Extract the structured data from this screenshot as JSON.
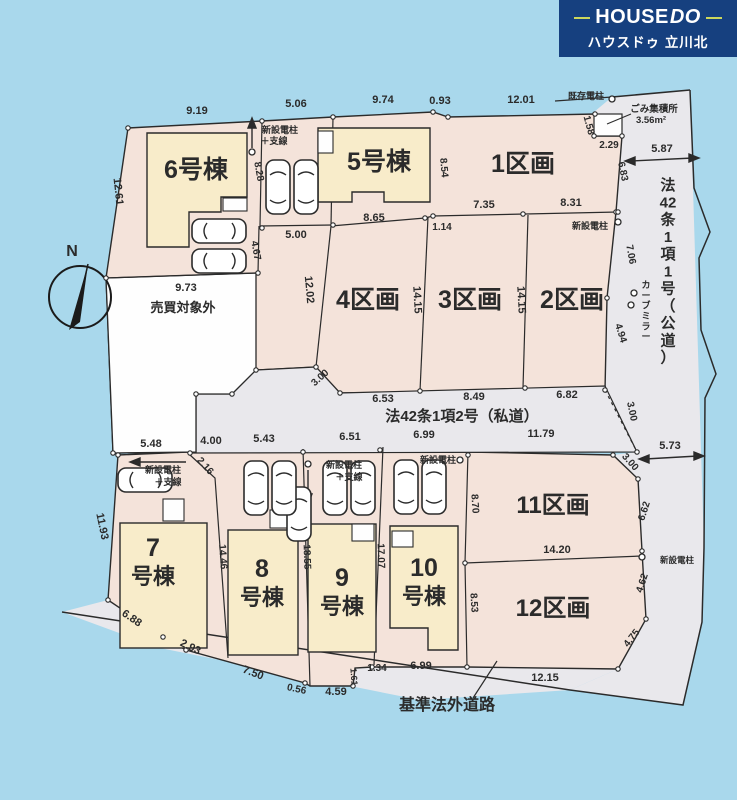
{
  "header": {
    "brand": "HOUSE",
    "brand2": "DO",
    "subtitle": "ハウスドゥ 立川北",
    "colors": {
      "navy": "#16407f",
      "accent_rule": "#ccd75c",
      "text": "#ffffff"
    }
  },
  "plan": {
    "colors": {
      "background": "#a9d8ec",
      "lot_pink": "#f4e3da",
      "road_gray": "#e9e8ec",
      "building_cream": "#f8ecca",
      "white_area": "#fefefe",
      "line_ink": "#2b2b2b"
    },
    "labels": [
      {
        "t": "9.19",
        "x": 197,
        "y": 114,
        "s": 11,
        "n": "dim-label"
      },
      {
        "t": "5.06",
        "x": 296,
        "y": 107,
        "s": 11,
        "n": "dim-label"
      },
      {
        "t": "9.74",
        "x": 383,
        "y": 103,
        "s": 11,
        "n": "dim-label"
      },
      {
        "t": "0.93",
        "x": 440,
        "y": 104,
        "s": 11,
        "n": "dim-label"
      },
      {
        "t": "12.01",
        "x": 521,
        "y": 103,
        "s": 11,
        "n": "dim-label"
      },
      {
        "t": "1.58",
        "x": 586,
        "y": 126,
        "s": 10,
        "r": 75,
        "n": "dim-label"
      },
      {
        "t": "2.29",
        "x": 609,
        "y": 148,
        "s": 10,
        "n": "dim-label"
      },
      {
        "t": "5.87",
        "x": 662,
        "y": 152,
        "s": 11,
        "n": "dim-label"
      },
      {
        "t": "6.83",
        "x": 620,
        "y": 172,
        "s": 10,
        "r": 78,
        "n": "dim-label"
      },
      {
        "t": "12.61",
        "x": 115,
        "y": 192,
        "s": 11,
        "r": 84,
        "n": "dim-label"
      },
      {
        "t": "8.28",
        "x": 256,
        "y": 172,
        "s": 10,
        "r": 80,
        "n": "dim-label"
      },
      {
        "t": "8.54",
        "x": 441,
        "y": 168,
        "s": 10,
        "r": 85,
        "n": "dim-label"
      },
      {
        "t": "5.00",
        "x": 296,
        "y": 238,
        "s": 11,
        "n": "dim-label"
      },
      {
        "t": "8.65",
        "x": 374,
        "y": 221,
        "s": 11,
        "n": "dim-label"
      },
      {
        "t": "1.14",
        "x": 442,
        "y": 230,
        "s": 10,
        "n": "dim-label"
      },
      {
        "t": "7.35",
        "x": 484,
        "y": 208,
        "s": 11,
        "n": "dim-label"
      },
      {
        "t": "8.31",
        "x": 571,
        "y": 206,
        "s": 11,
        "n": "dim-label"
      },
      {
        "t": "4.67",
        "x": 253,
        "y": 251,
        "s": 10,
        "r": 80,
        "n": "dim-label"
      },
      {
        "t": "9.73",
        "x": 186,
        "y": 291,
        "s": 11,
        "n": "dim-label"
      },
      {
        "t": "12.02",
        "x": 306,
        "y": 290,
        "s": 11,
        "r": 85,
        "n": "dim-label"
      },
      {
        "t": "14.15",
        "x": 414,
        "y": 300,
        "s": 11,
        "r": 87,
        "n": "dim-label"
      },
      {
        "t": "14.15",
        "x": 518,
        "y": 300,
        "s": 11,
        "r": 87,
        "n": "dim-label"
      },
      {
        "t": "7.06",
        "x": 628,
        "y": 255,
        "s": 10,
        "r": 80,
        "n": "dim-label"
      },
      {
        "t": "4.94",
        "x": 618,
        "y": 334,
        "s": 10,
        "r": 72,
        "n": "dim-label"
      },
      {
        "t": "3.00",
        "x": 629,
        "y": 412,
        "s": 10,
        "r": 78,
        "n": "dim-label"
      },
      {
        "t": "3.00",
        "x": 322,
        "y": 380,
        "s": 10,
        "r": -42,
        "n": "dim-label"
      },
      {
        "t": "6.53",
        "x": 383,
        "y": 402,
        "s": 11,
        "n": "dim-label"
      },
      {
        "t": "8.49",
        "x": 474,
        "y": 400,
        "s": 11,
        "n": "dim-label"
      },
      {
        "t": "6.82",
        "x": 567,
        "y": 398,
        "s": 11,
        "n": "dim-label"
      },
      {
        "t": "5.73",
        "x": 670,
        "y": 449,
        "s": 11,
        "n": "dim-label"
      },
      {
        "t": "5.48",
        "x": 151,
        "y": 447,
        "s": 11,
        "n": "dim-label"
      },
      {
        "t": "4.00",
        "x": 211,
        "y": 444,
        "s": 11,
        "n": "dim-label"
      },
      {
        "t": "5.43",
        "x": 264,
        "y": 442,
        "s": 11,
        "n": "dim-label"
      },
      {
        "t": "6.51",
        "x": 350,
        "y": 440,
        "s": 11,
        "n": "dim-label"
      },
      {
        "t": "6.99",
        "x": 424,
        "y": 438,
        "s": 11,
        "n": "dim-label"
      },
      {
        "t": "11.79",
        "x": 541,
        "y": 437,
        "s": 11,
        "n": "dim-label"
      },
      {
        "t": "2.16",
        "x": 203,
        "y": 468,
        "s": 10,
        "r": 48,
        "n": "dim-label"
      },
      {
        "t": "3.00",
        "x": 628,
        "y": 464,
        "s": 10,
        "r": 48,
        "n": "dim-label"
      },
      {
        "t": "11.93",
        "x": 99,
        "y": 527,
        "s": 11,
        "r": 78,
        "n": "dim-label"
      },
      {
        "t": "14.46",
        "x": 220,
        "y": 557,
        "s": 10,
        "r": 86,
        "n": "dim-label"
      },
      {
        "t": "18.55",
        "x": 304,
        "y": 557,
        "s": 10,
        "r": 88,
        "n": "dim-label"
      },
      {
        "t": "17.07",
        "x": 378,
        "y": 556,
        "s": 10,
        "r": 88,
        "n": "dim-label"
      },
      {
        "t": "8.70",
        "x": 472,
        "y": 504,
        "s": 10,
        "r": 86,
        "n": "dim-label"
      },
      {
        "t": "8.53",
        "x": 471,
        "y": 603,
        "s": 10,
        "r": 86,
        "n": "dim-label"
      },
      {
        "t": "6.62",
        "x": 647,
        "y": 512,
        "s": 10,
        "r": -72,
        "n": "dim-label"
      },
      {
        "t": "14.20",
        "x": 557,
        "y": 553,
        "s": 11,
        "n": "dim-label"
      },
      {
        "t": "4.62",
        "x": 645,
        "y": 584,
        "s": 10,
        "r": -72,
        "n": "dim-label"
      },
      {
        "t": "4.75",
        "x": 634,
        "y": 640,
        "s": 10,
        "r": -52,
        "n": "dim-label"
      },
      {
        "t": "12.15",
        "x": 545,
        "y": 681,
        "s": 11,
        "n": "dim-label"
      },
      {
        "t": "6.88",
        "x": 130,
        "y": 621,
        "s": 11,
        "r": 34,
        "n": "dim-label"
      },
      {
        "t": "2.93",
        "x": 189,
        "y": 650,
        "s": 11,
        "r": 26,
        "n": "dim-label"
      },
      {
        "t": "7.50",
        "x": 252,
        "y": 676,
        "s": 11,
        "r": 21,
        "n": "dim-label"
      },
      {
        "t": "0.56",
        "x": 296,
        "y": 692,
        "s": 10,
        "r": 12,
        "n": "dim-label"
      },
      {
        "t": "4.59",
        "x": 336,
        "y": 695,
        "s": 11,
        "n": "dim-label"
      },
      {
        "t": "1.61",
        "x": 351,
        "y": 677,
        "s": 9,
        "r": 86,
        "n": "dim-label"
      },
      {
        "t": "1.34",
        "x": 377,
        "y": 671,
        "s": 10,
        "n": "dim-label"
      },
      {
        "t": "6.99",
        "x": 421,
        "y": 669,
        "s": 11,
        "n": "dim-label"
      },
      {
        "t": "1区画",
        "x": 523,
        "y": 172,
        "s": 25,
        "n": "lot-label-1"
      },
      {
        "t": "2区画",
        "x": 572,
        "y": 308,
        "s": 25,
        "n": "lot-label-2"
      },
      {
        "t": "3区画",
        "x": 470,
        "y": 308,
        "s": 25,
        "n": "lot-label-3"
      },
      {
        "t": "4区画",
        "x": 368,
        "y": 308,
        "s": 25,
        "n": "lot-label-4"
      },
      {
        "t": "11区画",
        "x": 553,
        "y": 513,
        "s": 24,
        "n": "lot-label-11"
      },
      {
        "t": "12区画",
        "x": 553,
        "y": 616,
        "s": 24,
        "n": "lot-label-12"
      },
      {
        "t": "6号棟",
        "x": 196,
        "y": 178,
        "s": 25,
        "n": "building-label-6"
      },
      {
        "t": "5号棟",
        "x": 379,
        "y": 170,
        "s": 25,
        "n": "building-label-5"
      },
      {
        "t": "7",
        "x": 153,
        "y": 556,
        "s": 25,
        "n": "building-label-7"
      },
      {
        "t": "号棟",
        "x": 153,
        "y": 584,
        "s": 22,
        "n": "building-label-7b"
      },
      {
        "t": "8",
        "x": 262,
        "y": 577,
        "s": 25,
        "n": "building-label-8"
      },
      {
        "t": "号棟",
        "x": 262,
        "y": 605,
        "s": 22,
        "n": "building-label-8b"
      },
      {
        "t": "9",
        "x": 342,
        "y": 586,
        "s": 25,
        "n": "building-label-9"
      },
      {
        "t": "号棟",
        "x": 342,
        "y": 614,
        "s": 22,
        "n": "building-label-9b"
      },
      {
        "t": "10",
        "x": 424,
        "y": 576,
        "s": 25,
        "n": "building-label-10"
      },
      {
        "t": "号棟",
        "x": 424,
        "y": 604,
        "s": 22,
        "n": "building-label-10b"
      },
      {
        "t": "売買対象外",
        "x": 183,
        "y": 312,
        "s": 13,
        "n": "excluded-area-label"
      },
      {
        "t": "法42条1項2号（私道）",
        "x": 462,
        "y": 421,
        "s": 15,
        "n": "road-label-private"
      },
      {
        "t": "基準法外道路",
        "x": 447,
        "y": 710,
        "s": 16,
        "n": "road-label-nonstandard"
      },
      {
        "t": "法42条1項1号（公道）",
        "x": 668,
        "y": 190,
        "s": 15,
        "v": true,
        "units": [
          "法",
          "42",
          "条",
          "1",
          "項",
          "1",
          "号",
          "（",
          "公",
          "道",
          "）"
        ],
        "n": "road-label-public"
      },
      {
        "t": "カーブミラー",
        "x": 646,
        "y": 288,
        "s": 9,
        "v": true,
        "units": [
          "カ",
          "ー",
          "ブ",
          "ミ",
          "ラ",
          "ー"
        ],
        "n": "curve-mirror-label"
      },
      {
        "t": "ごみ集積所",
        "x": 654,
        "y": 112,
        "s": 9.5,
        "n": "garbage-station-label"
      },
      {
        "t": "3.56m²",
        "x": 651,
        "y": 123,
        "s": 9.5,
        "n": "garbage-area-label"
      },
      {
        "t": "既存電柱",
        "x": 586,
        "y": 99,
        "s": 9,
        "n": "existing-pole-label"
      },
      {
        "t": "新設電柱",
        "x": 280,
        "y": 133,
        "s": 9,
        "n": "new-pole-label"
      },
      {
        "t": "＋支線",
        "x": 274,
        "y": 144,
        "s": 9,
        "n": "new-pole-label"
      },
      {
        "t": "新設電柱",
        "x": 590,
        "y": 229,
        "s": 9,
        "n": "new-pole-label"
      },
      {
        "t": "新設電柱",
        "x": 163,
        "y": 473,
        "s": 9,
        "n": "new-pole-label"
      },
      {
        "t": "＋支線",
        "x": 168,
        "y": 485,
        "s": 9,
        "n": "new-pole-label"
      },
      {
        "t": "新設電柱",
        "x": 344,
        "y": 468,
        "s": 9,
        "n": "new-pole-label"
      },
      {
        "t": "＋支線",
        "x": 349,
        "y": 480,
        "s": 9,
        "n": "new-pole-label"
      },
      {
        "t": "新設電柱",
        "x": 438,
        "y": 463,
        "s": 9,
        "n": "new-pole-label"
      },
      {
        "t": "新設電柱",
        "x": 677,
        "y": 563,
        "s": 8.5,
        "n": "new-pole-label"
      },
      {
        "t": "N",
        "x": 72,
        "y": 256,
        "s": 16,
        "n": "compass-north-label"
      }
    ],
    "cars": [
      {
        "x": 266,
        "y": 160,
        "dir": "v"
      },
      {
        "x": 294,
        "y": 160,
        "dir": "v"
      },
      {
        "x": 192,
        "y": 219,
        "dir": "h"
      },
      {
        "x": 192,
        "y": 249,
        "dir": "h"
      },
      {
        "x": 118,
        "y": 468,
        "dir": "h"
      },
      {
        "x": 287,
        "y": 487,
        "dir": "v"
      },
      {
        "x": 244,
        "y": 461,
        "dir": "v"
      },
      {
        "x": 272,
        "y": 461,
        "dir": "v"
      },
      {
        "x": 323,
        "y": 461,
        "dir": "v"
      },
      {
        "x": 351,
        "y": 461,
        "dir": "v"
      },
      {
        "x": 394,
        "y": 460,
        "dir": "v"
      },
      {
        "x": 422,
        "y": 460,
        "dir": "v"
      }
    ],
    "poles": [
      {
        "x": 612,
        "y": 99
      },
      {
        "x": 618,
        "y": 222
      },
      {
        "x": 252,
        "y": 152
      },
      {
        "x": 308,
        "y": 464
      },
      {
        "x": 460,
        "y": 460
      },
      {
        "x": 642,
        "y": 557
      },
      {
        "x": 634,
        "y": 293
      },
      {
        "x": 631,
        "y": 305
      }
    ]
  }
}
